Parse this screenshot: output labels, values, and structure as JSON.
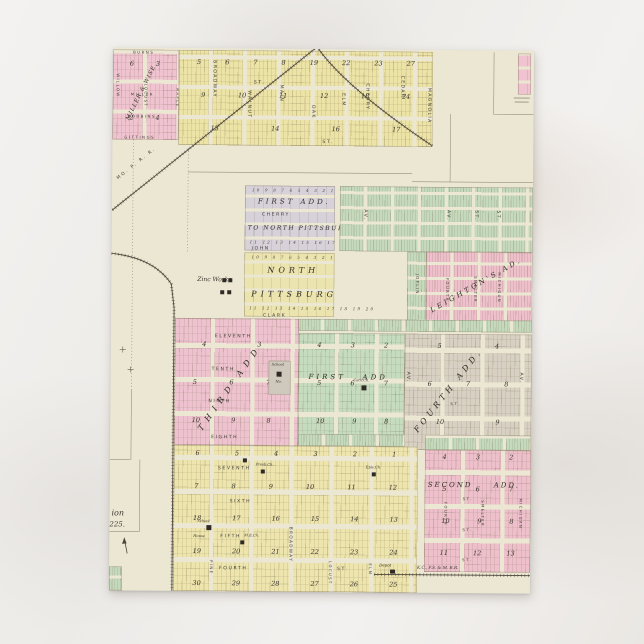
{
  "card": {
    "misc": {
      "st": "ST.",
      "av": "AV."
    },
    "railroads": {
      "mo_p": "MO. P. R. R.",
      "kcfsm": "K.C., F.S. & M. R.R."
    },
    "landmarks": {
      "zinc_works": "Zinc Works",
      "school_word": "School",
      "school_no": "No.",
      "cath_ch": "Cath.Ch.",
      "presb_ch": "Presb.Ch.",
      "epis_ch": "Epis.Ch.",
      "house": "House",
      "me_ch": "M.E.Ch.",
      "depot": "Depot"
    },
    "edge_fragments": {
      "line1": "ion",
      "line2": "225."
    },
    "miller_wise": {
      "name": "MILLER & WISE",
      "burns": "BURNS",
      "miller": "MILLER",
      "robbins": "ROBBINS",
      "gittings": "GITTINGS",
      "willow": "WILLOW",
      "locust": "LOCUST",
      "maple": "MAPLE",
      "blocks": [
        [
          "6",
          "3"
        ],
        [
          "2",
          "4"
        ]
      ]
    },
    "top_town": {
      "streets": {
        "broadway": "BROADWAY",
        "walnut": "WALNUT",
        "main": "MAIN",
        "oak": "OAK",
        "elm": "ELM",
        "cherry": "CHERRY",
        "cedar": "CEDAR",
        "magnolia": "MAGNOLIA"
      },
      "blocks": [
        [
          "5",
          "6",
          "7",
          "8",
          "19",
          "22",
          "23",
          "27"
        ],
        [
          "9",
          "10",
          "11",
          "12",
          "18",
          "24"
        ],
        [
          "13",
          "14",
          "16",
          "17"
        ]
      ]
    },
    "north_pittsburg": {
      "first_add": "FIRST ADD.",
      "to_line": "TO NORTH PITTSBURG",
      "north": "NORTH",
      "pittsburg": "PITTSBURG",
      "cherry": "CHERRY",
      "john": "JOHN",
      "clark": "CLARK",
      "lots_a": "10 9 8 7 6 5 4 3 2 1",
      "lots_b": "11 12 13 14 15 16 17 18 19 20"
    },
    "leighton": {
      "name": "LEIGHTON'S AD.",
      "joplin": "JOPLIN",
      "fourth": "FOURTH",
      "smelter": "SMELTER",
      "michigan": "MICHIGAN"
    },
    "third_add": {
      "name": "THIRD ADD",
      "eleventh": "ELEVENTH",
      "tenth": "TENTH",
      "ninth": "NINTH",
      "eighth": "EIGHTH",
      "blocks": [
        [
          "4",
          "3"
        ],
        [
          "5",
          "6",
          "7"
        ],
        [
          "10",
          "9",
          "8"
        ]
      ]
    },
    "first_add_main": {
      "word1": "FIRST",
      "word2": "ADD",
      "blocks": [
        [
          "4",
          "3",
          "2"
        ],
        [
          "5",
          "6",
          "7"
        ],
        [
          "10",
          "9",
          "8"
        ]
      ]
    },
    "fourth_add": {
      "name": "FOURTH ADD.",
      "blocks": [
        [
          "5",
          "4"
        ],
        [
          "6",
          "7",
          "8"
        ],
        [
          "10",
          "9"
        ]
      ]
    },
    "bottom_town": {
      "seventh": "SEVENTH",
      "sixth": "SIXTH",
      "fifth": "FIFTH",
      "fourth": "FOURTH",
      "pine": "PINE",
      "broadway": "BROADWAY",
      "locust": "LOCUST",
      "elm": "ELM",
      "blocks": [
        [
          "6",
          "5",
          "4",
          "3",
          "2",
          "1"
        ],
        [
          "7",
          "8",
          "9",
          "10",
          "11",
          "12"
        ],
        [
          "18",
          "17",
          "16",
          "15",
          "14",
          "13"
        ],
        [
          "19",
          "20",
          "21",
          "22",
          "23",
          "24"
        ],
        [
          "30",
          "29",
          "28",
          "27",
          "26",
          "25"
        ]
      ]
    },
    "second_add": {
      "word1": "SECOND",
      "word2": "ADD.",
      "fourth": "FOURTH",
      "smelter": "SMELTER",
      "michigan": "MICHIGAN",
      "blocks": [
        [
          "4",
          "3",
          "2"
        ],
        [
          "5",
          "6",
          "7"
        ],
        [
          "10",
          "9",
          "8"
        ],
        [
          "11",
          "12",
          "13"
        ]
      ]
    }
  }
}
